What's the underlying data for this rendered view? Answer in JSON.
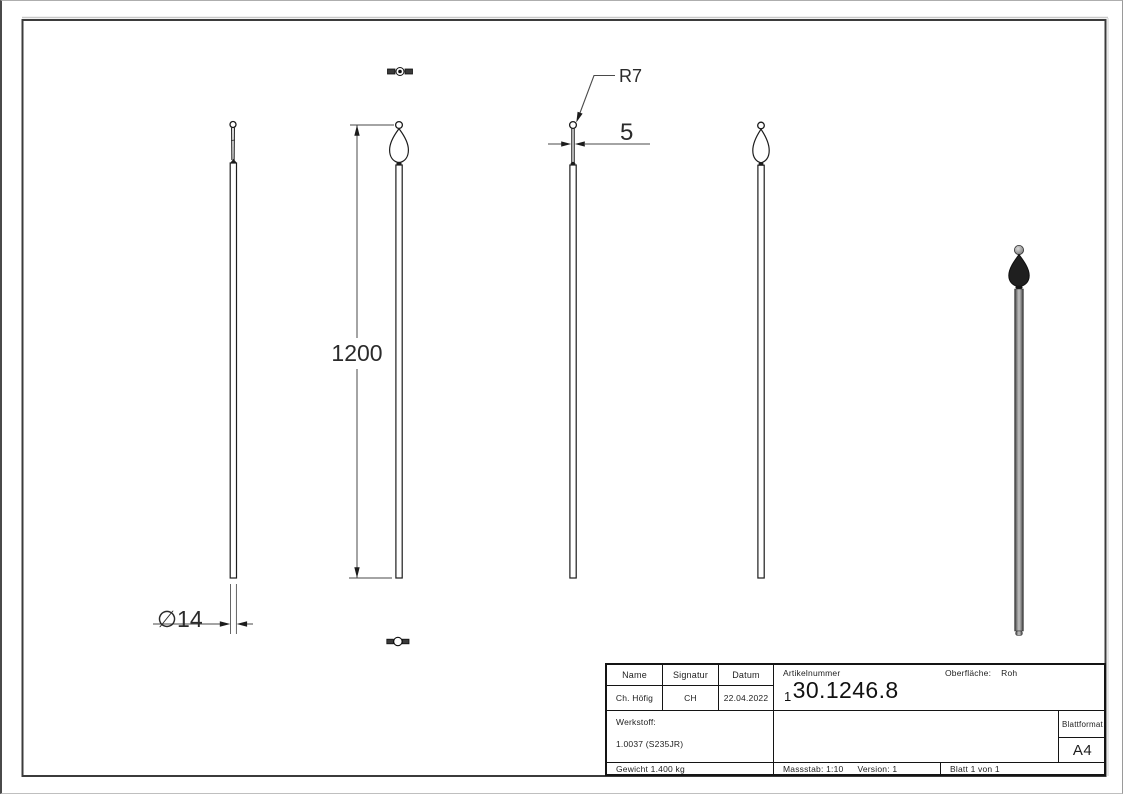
{
  "drawing": {
    "dimensions": {
      "length": "1200",
      "diameter": "∅14",
      "radius": "R7",
      "drop_width": "5"
    }
  },
  "title_block": {
    "name_header": "Name",
    "signature_header": "Signatur",
    "date_header": "Datum",
    "name_value": "Ch. Höfig",
    "signature_value": "CH",
    "date_value": "22.04.2022",
    "article_label": "Artikelnummer",
    "article_prefix": "1",
    "article_number": "30.1246.8",
    "surface_label": "Oberfläche:",
    "surface_value": "Roh",
    "material_label": "Werkstoff:",
    "material_value": "1.0037 (S235JR)",
    "sheet_format_label": "Blattformat",
    "sheet_format_value": "A4",
    "weight": "Gewicht 1.400 kg",
    "scale": "Massstab: 1:10",
    "version": "Version: 1",
    "sheet": "Blatt 1 von 1"
  },
  "colors": {
    "line": "#1c1c1c",
    "dim_line": "#4a4a4a",
    "render_dark": "#1f1f1f"
  }
}
